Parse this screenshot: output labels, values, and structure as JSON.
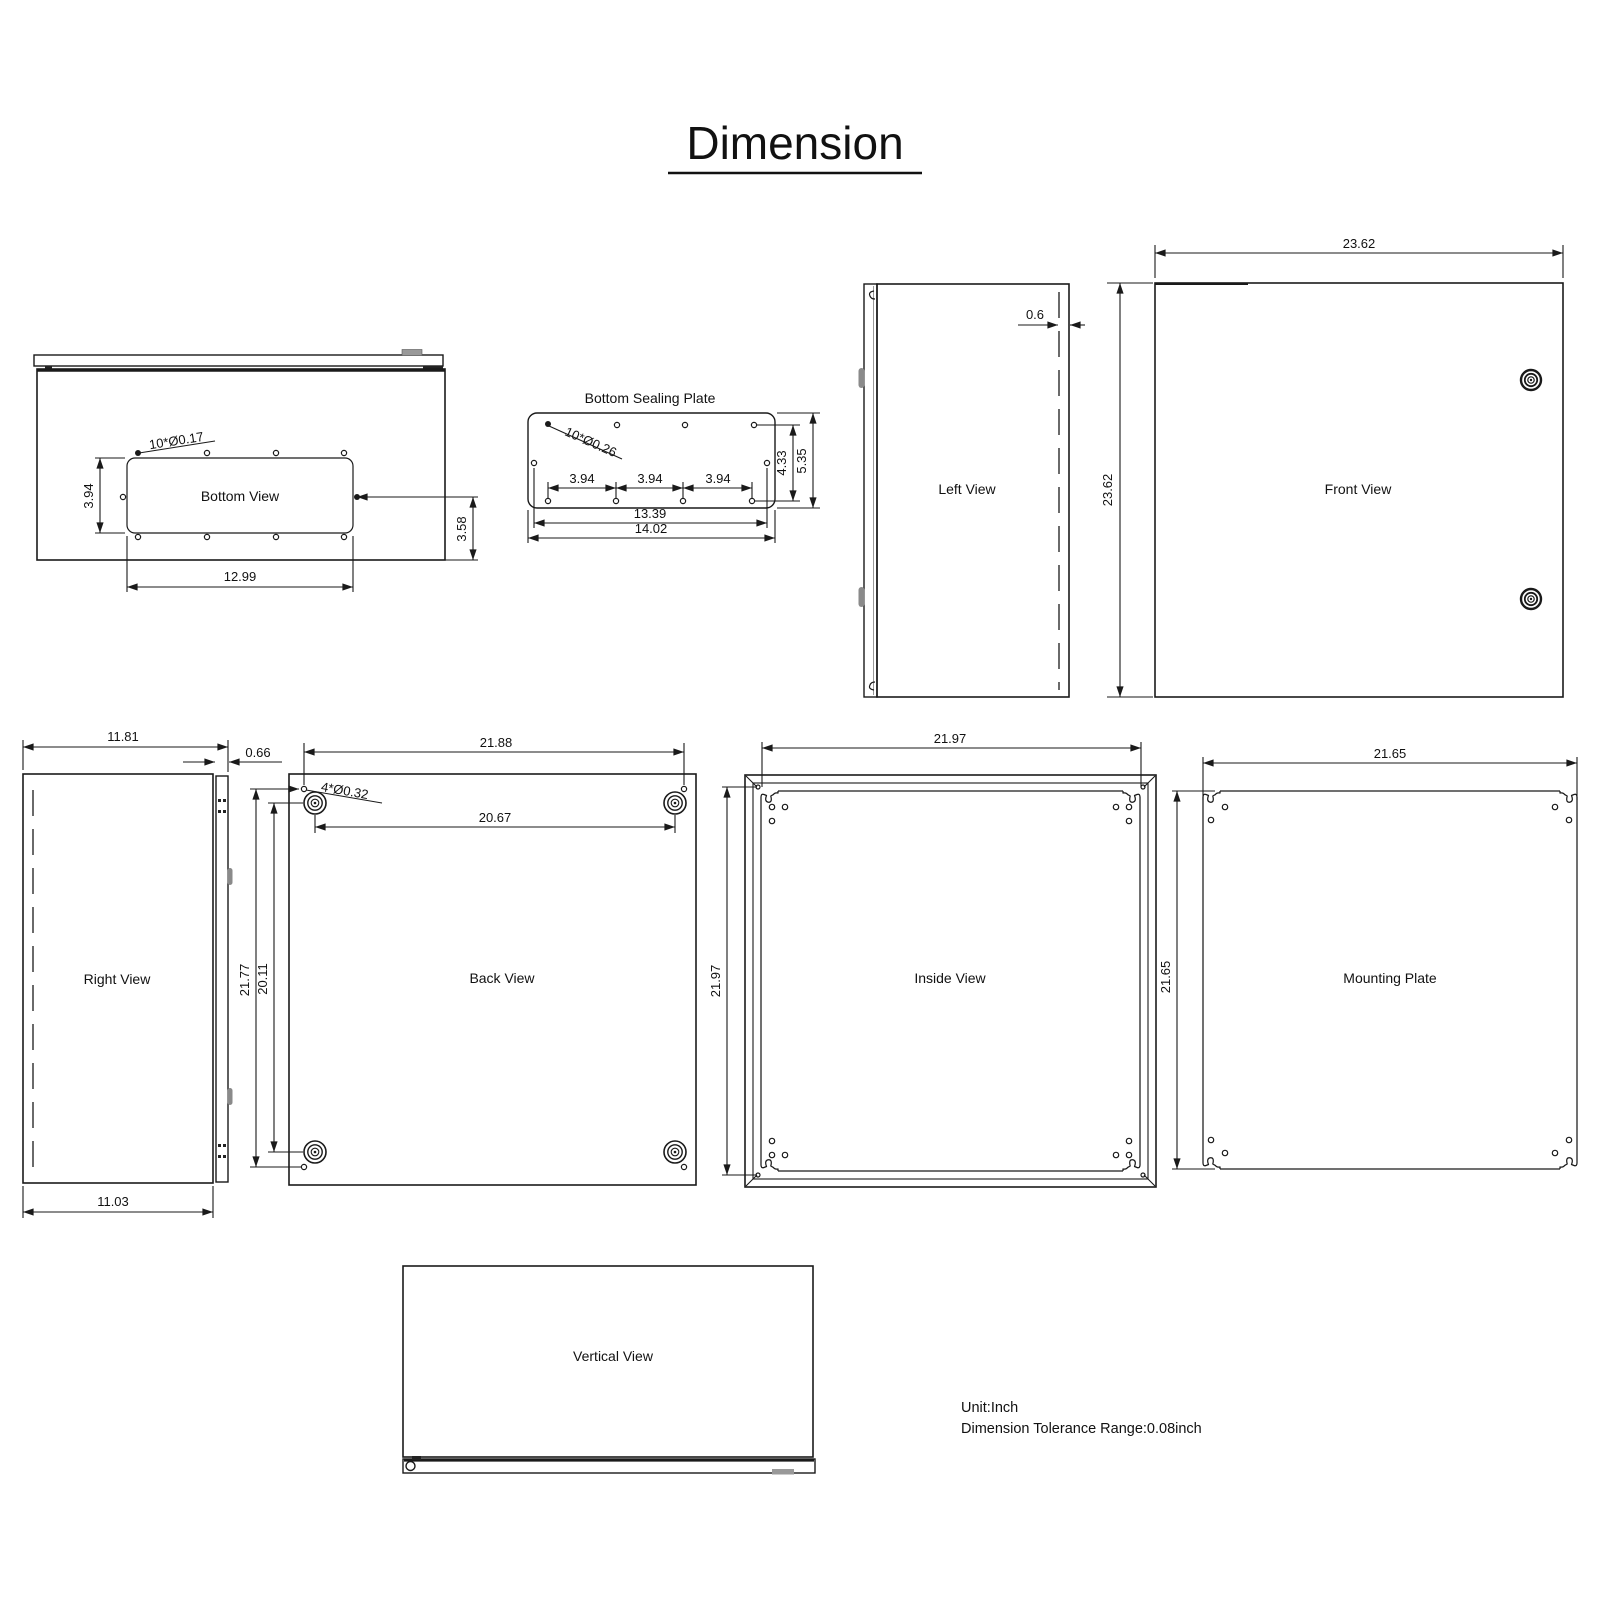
{
  "title": "Dimension",
  "notes": {
    "unit": "Unit:Inch",
    "tolerance": "Dimension Tolerance Range:0.08inch"
  },
  "views": {
    "bottom_view": {
      "label": "Bottom View",
      "holes": "10*Ø0.17",
      "cutout_height": "3.94",
      "cutout_width": "12.99",
      "side_depth": "3.58"
    },
    "bottom_sealing_plate": {
      "label": "Bottom Sealing Plate",
      "holes": "10*Ø0.26",
      "pitch_1": "3.94",
      "pitch_2": "3.94",
      "pitch_3": "3.94",
      "hole_span": "13.39",
      "width": "14.02",
      "hole_height": "4.33",
      "height": "5.35"
    },
    "left_view": {
      "label": "Left View",
      "door_thickness": "0.6"
    },
    "front_view": {
      "label": "Front View",
      "width": "23.62",
      "height": "23.62"
    },
    "right_view": {
      "label": "Right View",
      "width_with_door": "11.81",
      "door_thickness": "0.66",
      "depth": "11.03"
    },
    "back_view": {
      "label": "Back View",
      "width": "21.88",
      "boss_span_h": "20.67",
      "holes": "4*Ø0.32",
      "height": "21.77",
      "boss_span_v": "20.11"
    },
    "inside_view": {
      "label": "Inside View",
      "width": "21.97",
      "height": "21.97"
    },
    "mounting_plate": {
      "label": "Mounting Plate",
      "width": "21.65",
      "height": "21.65"
    },
    "vertical_view": {
      "label": "Vertical View"
    }
  }
}
